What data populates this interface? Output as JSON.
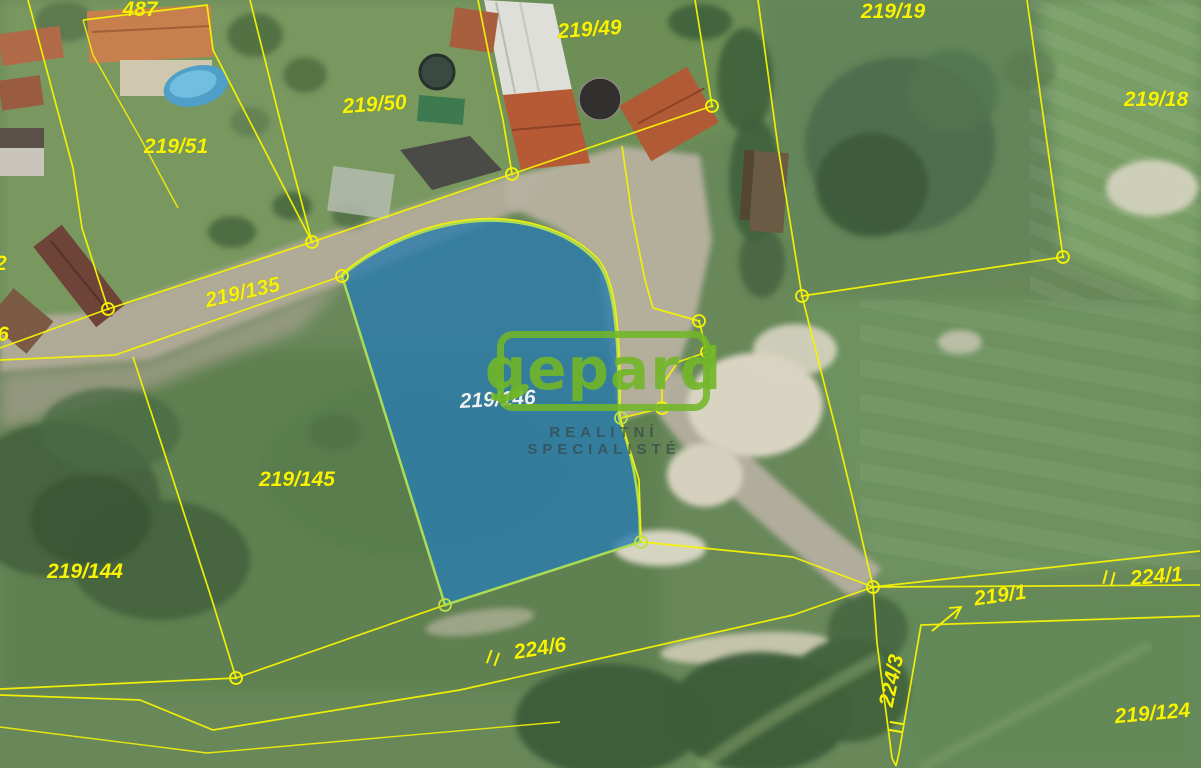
{
  "map": {
    "type": "cadastral-aerial-map",
    "watermark": {
      "brand": "gepard",
      "tagline": "REALITNÍ SPECIALISTÉ",
      "accent_color": "#71b628",
      "tagline_color": "#344648"
    },
    "highlight": {
      "parcel_number": "219/146",
      "fill_color": "#2c7cad",
      "outline_color": "#aadd55"
    },
    "boundary_color": "#f6f303",
    "label_color": "#f7f303",
    "labels": [
      {
        "text": "487",
        "x": 140,
        "y": 16,
        "rot": 0
      },
      {
        "text": "219/49",
        "x": 590,
        "y": 36,
        "rot": -4
      },
      {
        "text": "219/50",
        "x": 375,
        "y": 111,
        "rot": -4
      },
      {
        "text": "219/51",
        "x": 176,
        "y": 153,
        "rot": 0
      },
      {
        "text": "219/19",
        "x": 893,
        "y": 18,
        "rot": 0
      },
      {
        "text": "219/18",
        "x": 1156,
        "y": 106,
        "rot": 0
      },
      {
        "text": "219/135",
        "x": 244,
        "y": 299,
        "rot": -13
      },
      {
        "text": "219/146",
        "x": 498,
        "y": 406,
        "rot": -3,
        "c": "white"
      },
      {
        "text": "219/145",
        "x": 297,
        "y": 486,
        "rot": 0
      },
      {
        "text": "219/144",
        "x": 85,
        "y": 578,
        "rot": 0
      },
      {
        "text": "224/6",
        "x": 541,
        "y": 655,
        "rot": -9
      },
      {
        "text": "224/1",
        "x": 1157,
        "y": 583,
        "rot": -5
      },
      {
        "text": "219/1",
        "x": 1001,
        "y": 602,
        "rot": -8
      },
      {
        "text": "224/3",
        "x": 898,
        "y": 682,
        "rot": -78
      },
      {
        "text": "219/124",
        "x": 1153,
        "y": 720,
        "rot": -5
      },
      {
        "text": "2",
        "x": 1,
        "y": 270,
        "rot": 0
      },
      {
        "text": "6",
        "x": 3,
        "y": 341,
        "rot": 0
      }
    ]
  }
}
